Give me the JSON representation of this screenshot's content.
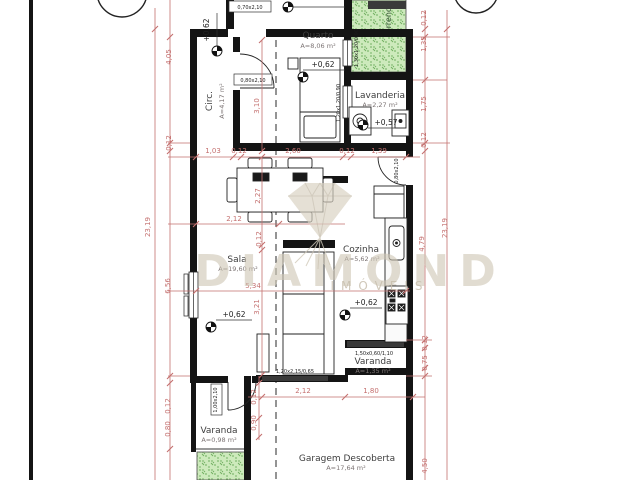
{
  "watermark": {
    "brand": "DIAMOND",
    "subbrand": "IMÓVEIS"
  },
  "rooms": {
    "quarto": {
      "name": "Quarto",
      "area": "A=8,06 m²"
    },
    "circ": {
      "name": "Circ.",
      "area": "A=4,17 m²"
    },
    "lavanderia": {
      "name": "Lavanderia",
      "area": "A=2,27 m²"
    },
    "terreno": {
      "name": "Terreno"
    },
    "sala": {
      "name": "Sala",
      "area": "A=19,60 m²"
    },
    "cozinha": {
      "name": "Cozinha",
      "area": "A=5,62 m²"
    },
    "varanda_dir": {
      "name": "Varanda",
      "area": "A=1,35 m²"
    },
    "varanda_esq": {
      "name": "Varanda",
      "area": "A=0,98 m²"
    },
    "garagem": {
      "name": "Garagem Descoberta",
      "area": "A=17,64 m²"
    }
  },
  "levels": {
    "circ": "+0,62",
    "quarto": "+0,62",
    "lavanderia": "+0,57",
    "sala": "+0,62",
    "cozinha": "+0,62"
  },
  "openings": {
    "door_banheiro": "0,70x2,10",
    "door_quarto": "0,80x2,10",
    "door_cozinha": "0,80x2,10",
    "door_varanda": "1,00x2,10",
    "window_quarto": "1,30x1,20/0,90",
    "window_lavanderia": "1,20x1,20/0,90",
    "window_sala": "1,20x2,15/0,65",
    "window_varanda": "1,50x0,60/1,10"
  },
  "dimensions": {
    "top_chain": [
      "1,03",
      "0,12",
      "2,60",
      "0,12",
      "1,39"
    ],
    "left_chain": {
      "total": "23,19",
      "circ": "4,05",
      "wall": "0,12",
      "sala": "6,56",
      "wall2": "0,12",
      "recuo": "0,80"
    },
    "right_chain": {
      "wall_top": "0,12",
      "terreno": "1,35",
      "lavanderia": "1,75",
      "wall_mid": "0,12",
      "total": "23,19",
      "cozinha": "4,79",
      "wall_low": "0,12",
      "varanda": "0,75",
      "garagem": "4,50"
    },
    "internal": {
      "quarto_depth": "3,10",
      "sala_top": "2,27",
      "wall_a": "0,12",
      "sala_bottom": "3,21",
      "sala_width": "2,12",
      "sala_total": "5,34",
      "garagem_a": "2,12",
      "garagem_b": "1,80",
      "varanda_wall": "0,12",
      "varanda_depth": "0,90"
    }
  },
  "colors": {
    "dimension": "#c4706f",
    "wall": "#141414",
    "green_area": "#cdeabc",
    "watermark": "#cfc7b6"
  }
}
